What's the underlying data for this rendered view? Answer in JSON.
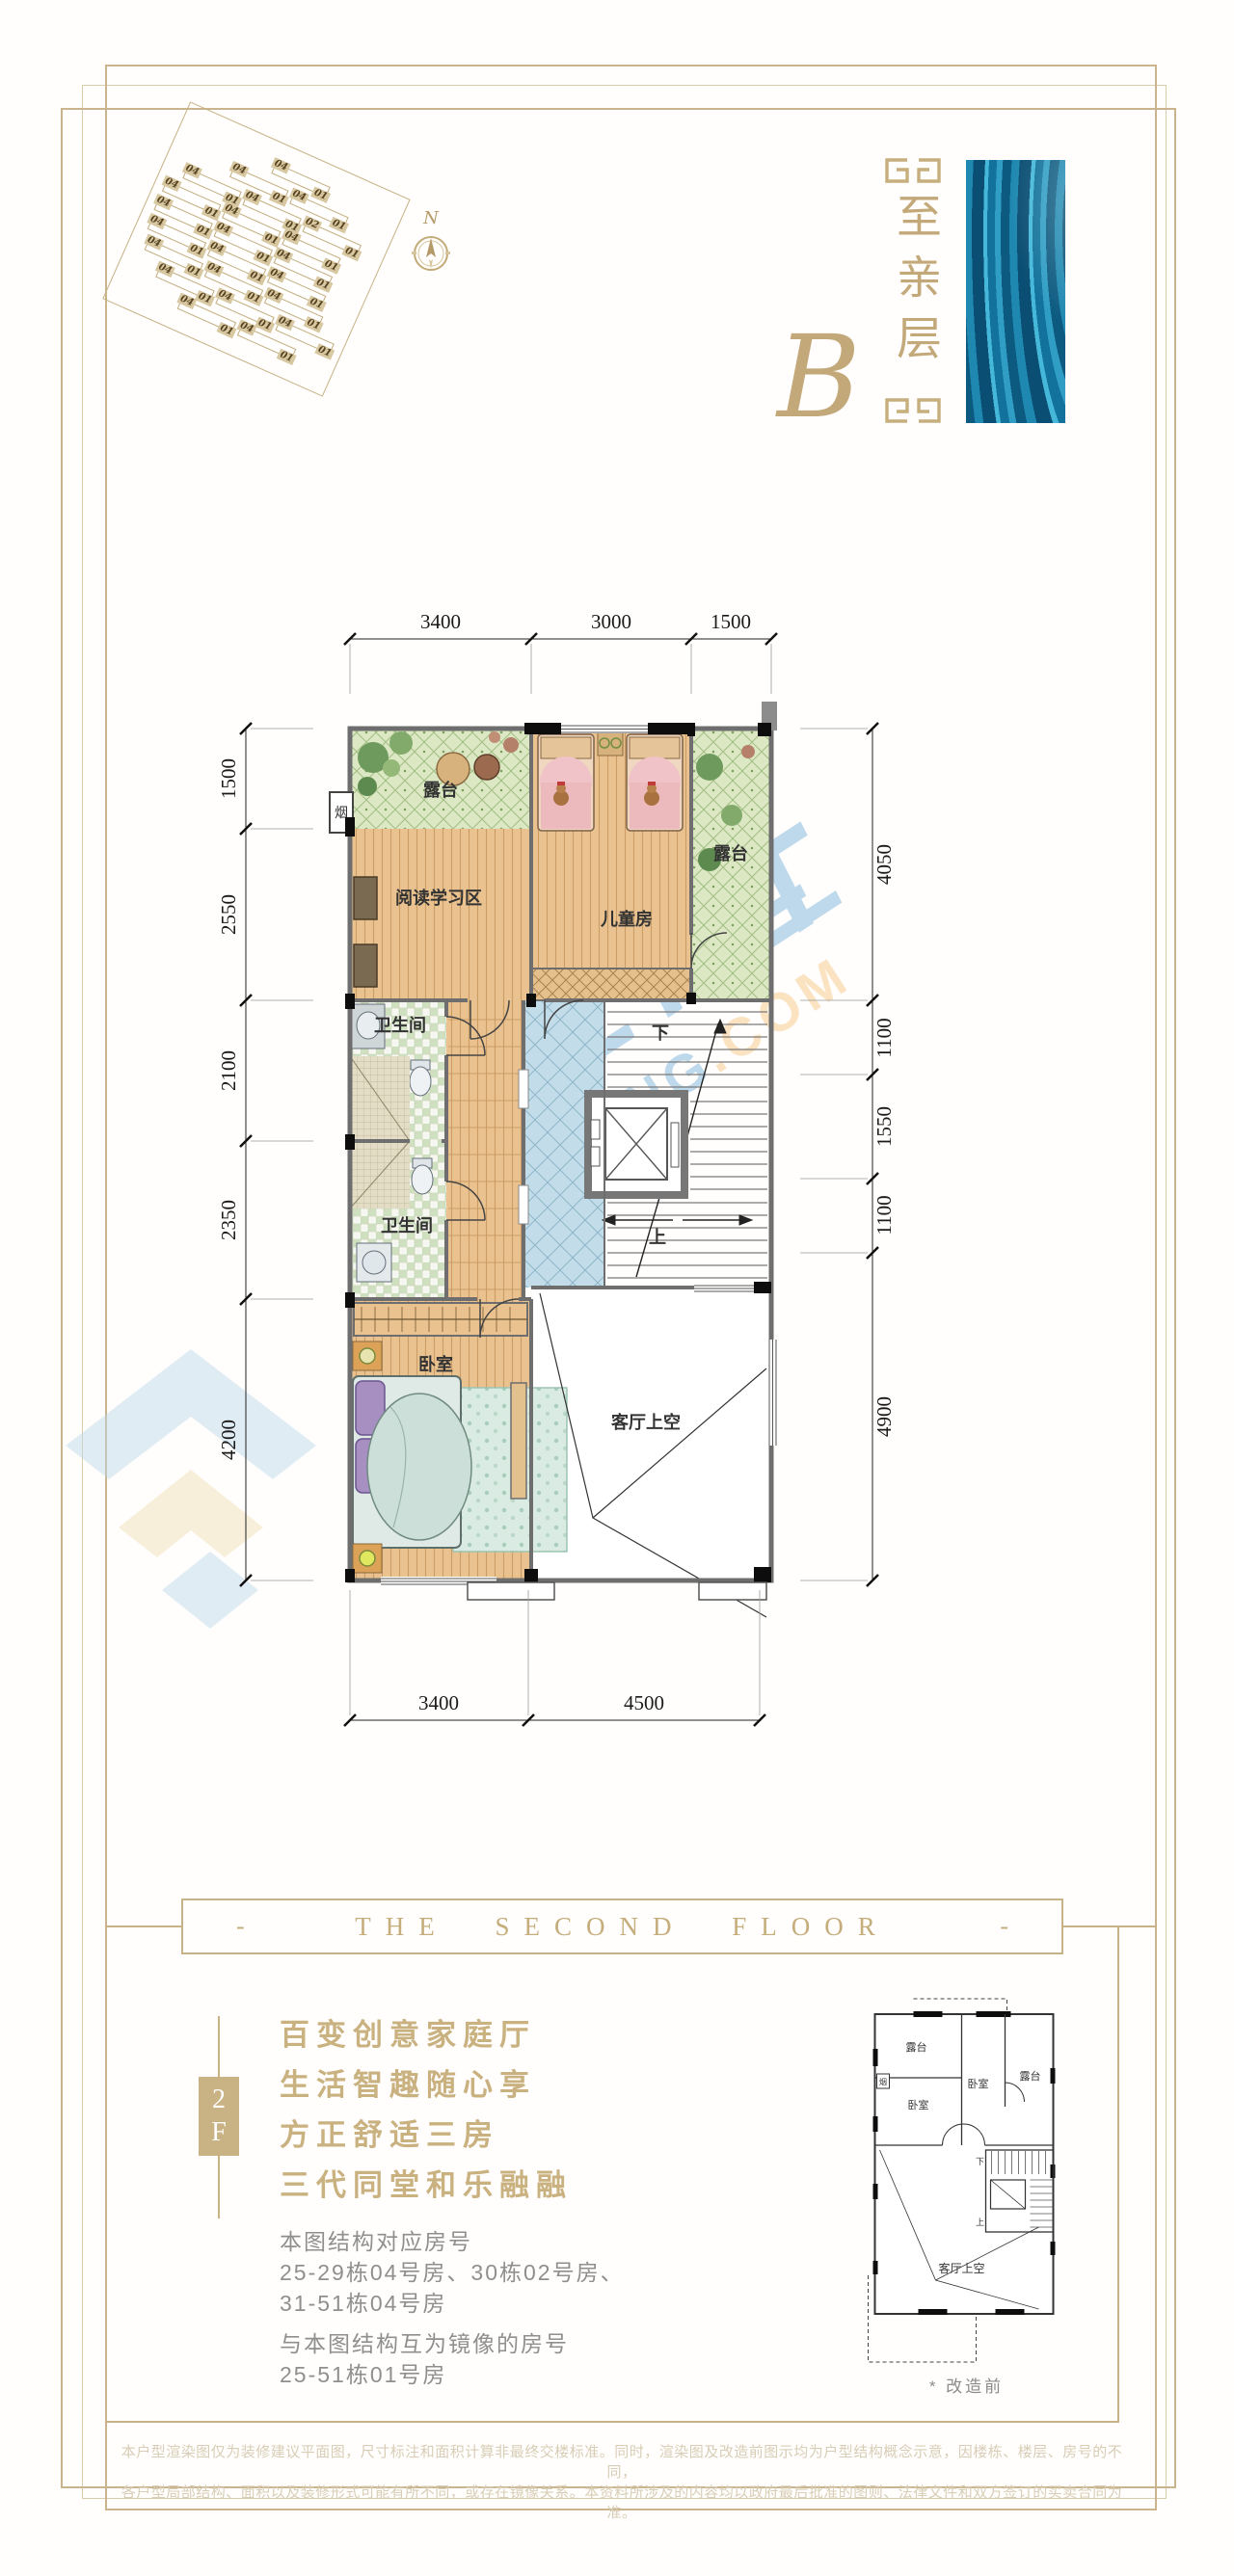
{
  "logo": {
    "floor_name": "至亲层",
    "letter": "B"
  },
  "site_plan": {
    "north_label": "N",
    "rows": [
      [
        "04",
        "01"
      ],
      [
        "04",
        "01",
        "04",
        "01"
      ],
      [
        "04",
        "01",
        "04",
        "01",
        "02",
        "01"
      ],
      [
        "04",
        "01",
        "04",
        "01",
        "04",
        "01"
      ],
      [
        "04",
        "01",
        "04",
        "01",
        "04",
        "01"
      ],
      [
        "04",
        "01",
        "04",
        "01",
        "04",
        "01"
      ],
      [
        "04",
        "01",
        "04",
        "01",
        "04",
        "01"
      ],
      [
        "04",
        "01",
        "04",
        "01",
        "04",
        "01"
      ],
      [
        "04",
        "01",
        "04",
        "01"
      ]
    ]
  },
  "floor_plan": {
    "rooms": {
      "terrace_left": "露台",
      "study": "阅读学习区",
      "kids_room": "儿童房",
      "terrace_right": "露台",
      "bath_1": "卫生间",
      "bath_2": "卫生间",
      "bedroom": "卧室",
      "living_void": "客厅上空",
      "chimney": "烟",
      "stair_down": "下",
      "stair_up": "上"
    },
    "dimensions": {
      "top": [
        "3400",
        "3000",
        "1500"
      ],
      "left": [
        "1500",
        "2550",
        "2100",
        "2350",
        "4200"
      ],
      "right": [
        "4050",
        "1100",
        "1550",
        "1100",
        "4900"
      ],
      "bottom": [
        "3400",
        "4500"
      ]
    }
  },
  "watermark": {
    "brand_blue": "PNFANG",
    "brand_orange": ".COM"
  },
  "section_heading": {
    "dash_left": "-",
    "title": "THE SECOND FLOOR",
    "dash_right": "-"
  },
  "floor_tag": {
    "level": "2",
    "suffix": "F"
  },
  "slogans": [
    "百变创意家庭厅",
    "生活智趣随心享",
    "方正舒适三房",
    "三代同堂和乐融融"
  ],
  "unit_info": {
    "title": "本图结构对应房号",
    "line1": "25-29栋04号房、30栋02号房、",
    "line2": "31-51栋04号房",
    "mirror_title": "与本图结构互为镜像的房号",
    "mirror_line": "25-51栋01号房"
  },
  "thumbnail": {
    "rooms": {
      "terrace_left": "露台",
      "terrace_right": "露台",
      "bedroom_left": "卧室",
      "bedroom_right": "卧室",
      "living_void": "客厅上空",
      "chimney": "烟",
      "stair_down": "下",
      "stair_up": "上"
    },
    "caption": "* 改造前"
  },
  "disclaimer": {
    "line1": "本户型渲染图仅为装修建议平面图，尺寸标注和面积计算非最终交楼标准。同时，渲染图及改造前图示均为户型结构概念示意，因楼栋、楼层、房号的不同，",
    "line2": "各户型局部结构、面积以及装修形式可能有所不同，或存在镜像关系。本资料所涉及的内容均以政府最后批准的图则、法律文件和双方签订的买卖合同为准。"
  },
  "colors": {
    "gold": "#c9b283",
    "text_gray": "#8f8f8f",
    "wm_blue": "#2e86c8",
    "wm_orange": "#f2a73e"
  }
}
